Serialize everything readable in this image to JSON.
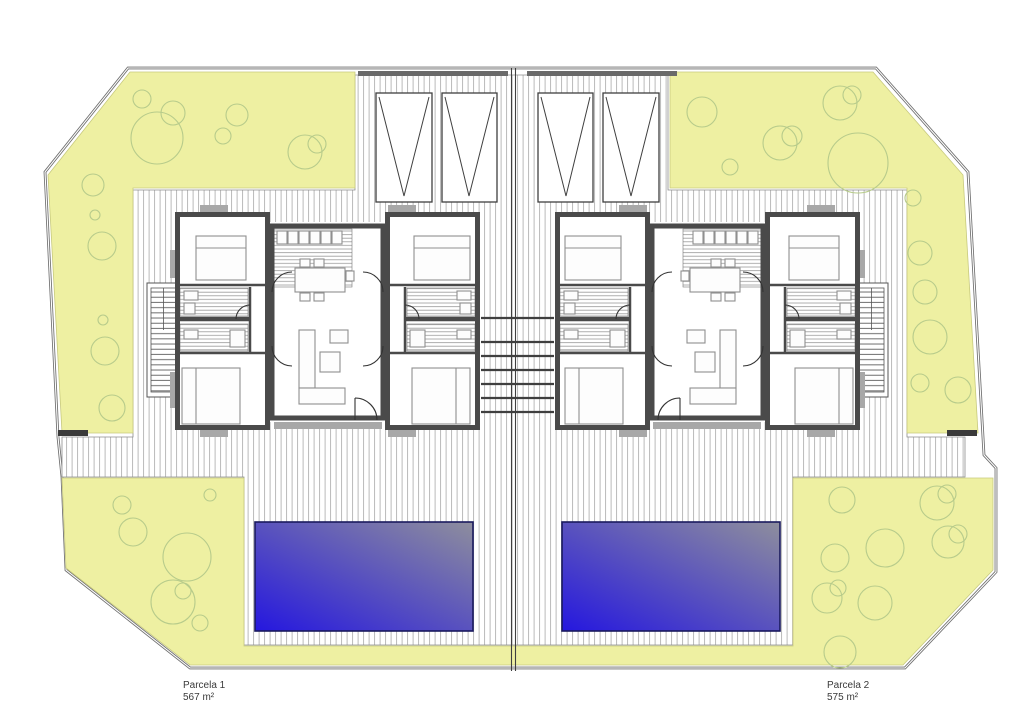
{
  "plan": {
    "type": "site-floor-plan",
    "units": [
      {
        "name": "Parcela 1",
        "area_m2": 567
      },
      {
        "name": "Parcela 2",
        "area_m2": 575
      }
    ]
  },
  "labels": {
    "parcel1_name": "Parcela 1",
    "parcel1_area": "567 m²",
    "parcel2_name": "Parcela 2",
    "parcel2_area": "575 m²"
  },
  "colors": {
    "garden": "#eef0a2",
    "tree_stroke": "#b7cb8b",
    "pool_bright": "#2517df",
    "pool_faded": "#8e8e9d",
    "pool_border": "#1a1a5e",
    "wall": "#4a4a4a",
    "paving_stripe": "#b3b3b3",
    "hatch_stripe": "#9a9a9a",
    "boundary": "#6e6e6e",
    "furniture": "#8f8f8f",
    "divider": "#3f3f3f"
  },
  "trees": [
    {
      "x": 142,
      "y": 99,
      "r": 9
    },
    {
      "x": 157,
      "y": 138,
      "r": 26
    },
    {
      "x": 173,
      "y": 113,
      "r": 12
    },
    {
      "x": 237,
      "y": 115,
      "r": 11
    },
    {
      "x": 223,
      "y": 136,
      "r": 8
    },
    {
      "x": 305,
      "y": 152,
      "r": 17
    },
    {
      "x": 317,
      "y": 144,
      "r": 9
    },
    {
      "x": 93,
      "y": 185,
      "r": 11
    },
    {
      "x": 95,
      "y": 215,
      "r": 5
    },
    {
      "x": 102,
      "y": 246,
      "r": 14
    },
    {
      "x": 103,
      "y": 320,
      "r": 5
    },
    {
      "x": 105,
      "y": 351,
      "r": 14
    },
    {
      "x": 112,
      "y": 408,
      "r": 13
    },
    {
      "x": 702,
      "y": 112,
      "r": 15
    },
    {
      "x": 730,
      "y": 167,
      "r": 8
    },
    {
      "x": 780,
      "y": 143,
      "r": 17
    },
    {
      "x": 792,
      "y": 136,
      "r": 10
    },
    {
      "x": 840,
      "y": 103,
      "r": 17
    },
    {
      "x": 852,
      "y": 95,
      "r": 9
    },
    {
      "x": 858,
      "y": 163,
      "r": 30
    },
    {
      "x": 913,
      "y": 198,
      "r": 8
    },
    {
      "x": 920,
      "y": 253,
      "r": 12
    },
    {
      "x": 925,
      "y": 292,
      "r": 12
    },
    {
      "x": 930,
      "y": 337,
      "r": 17
    },
    {
      "x": 920,
      "y": 383,
      "r": 9
    },
    {
      "x": 958,
      "y": 390,
      "r": 13
    },
    {
      "x": 122,
      "y": 505,
      "r": 9
    },
    {
      "x": 133,
      "y": 532,
      "r": 14
    },
    {
      "x": 187,
      "y": 557,
      "r": 24
    },
    {
      "x": 173,
      "y": 602,
      "r": 22
    },
    {
      "x": 183,
      "y": 591,
      "r": 8
    },
    {
      "x": 200,
      "y": 623,
      "r": 8
    },
    {
      "x": 210,
      "y": 495,
      "r": 6
    },
    {
      "x": 842,
      "y": 500,
      "r": 13
    },
    {
      "x": 937,
      "y": 503,
      "r": 17
    },
    {
      "x": 947,
      "y": 494,
      "r": 9
    },
    {
      "x": 885,
      "y": 548,
      "r": 19
    },
    {
      "x": 948,
      "y": 542,
      "r": 16
    },
    {
      "x": 958,
      "y": 534,
      "r": 9
    },
    {
      "x": 835,
      "y": 558,
      "r": 14
    },
    {
      "x": 827,
      "y": 598,
      "r": 15
    },
    {
      "x": 838,
      "y": 588,
      "r": 8
    },
    {
      "x": 875,
      "y": 603,
      "r": 17
    },
    {
      "x": 840,
      "y": 652,
      "r": 16
    }
  ]
}
